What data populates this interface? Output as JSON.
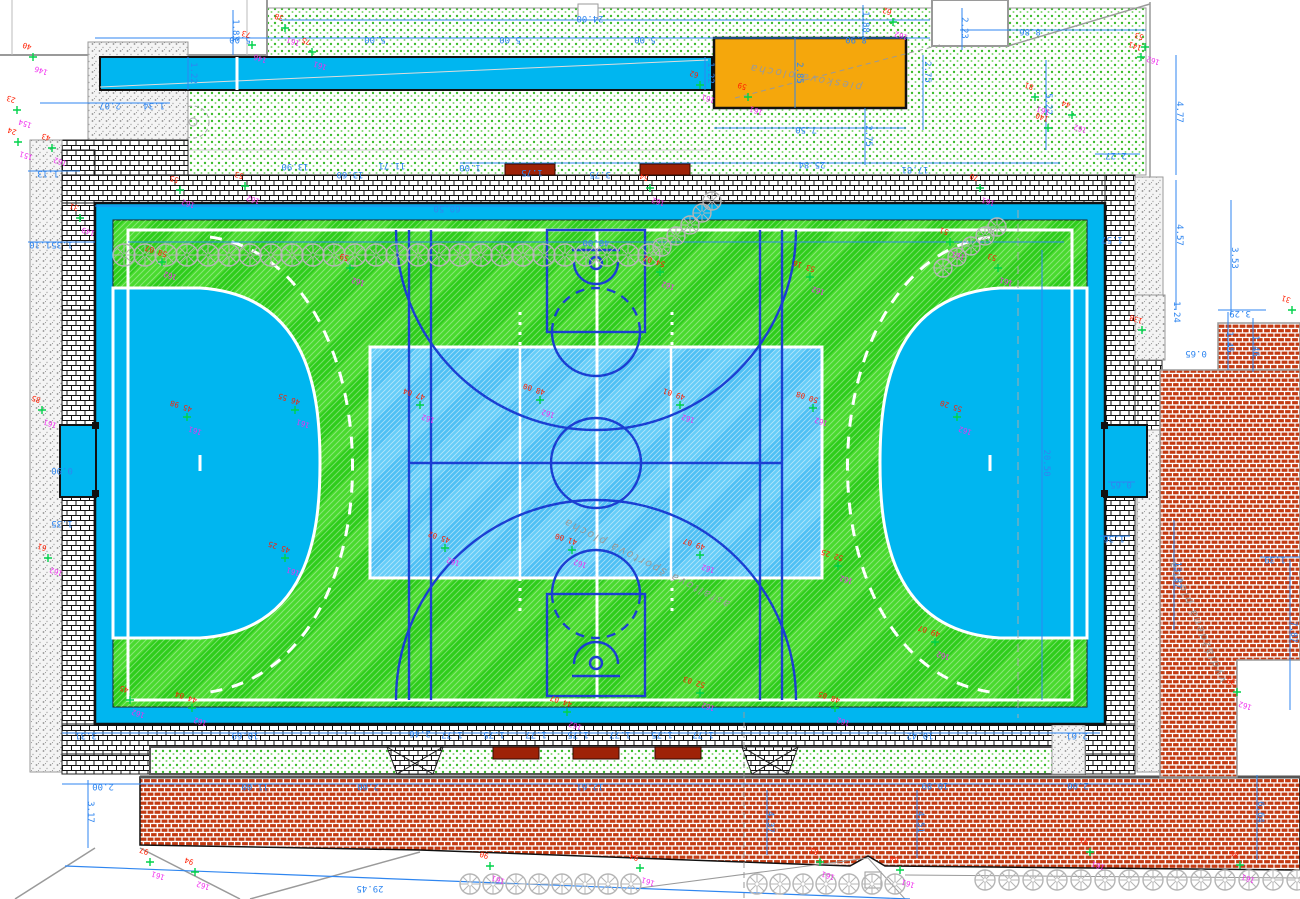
{
  "drawing": {
    "type": "site-plan-sports-field",
    "language": "sk"
  },
  "colors": {
    "dimension_blue": "#2f86f0",
    "spot_magenta": "#f030ee",
    "spot_red": "#ff1e00",
    "cross_green": "#00d24a",
    "court_band_cyan": "#00b6f0",
    "field_green": "#2ecd1b",
    "field_green_light": "#49da2e",
    "basket_court_blue": "#4fc0f4",
    "marking_dark_blue": "#1b3fd2",
    "sand_orange": "#f5a70c",
    "bench_red": "#9e2207",
    "paving_red_brick": "#c33a12",
    "tree_gray": "#b5b5b5"
  },
  "area_labels": [
    {
      "text": "piesková plocha",
      "x": 806,
      "y": 74,
      "rot": 190
    },
    {
      "text": "asfaltová športová plocha",
      "x": 648,
      "y": 560,
      "rot": 207
    },
    {
      "text": "vydláždená plocha",
      "x": 1200,
      "y": 620,
      "rot": 247
    }
  ],
  "dimensions": [
    {
      "t": "24.00",
      "x": 590,
      "y": 16,
      "o": "h"
    },
    {
      "t": "5.00",
      "x": 240,
      "y": 37,
      "o": "h"
    },
    {
      "t": "5.00",
      "x": 375,
      "y": 37,
      "o": "h"
    },
    {
      "t": "5.00",
      "x": 510,
      "y": 37,
      "o": "h"
    },
    {
      "t": "5.00",
      "x": 645,
      "y": 37,
      "o": "h"
    },
    {
      "t": "8.90",
      "x": 856,
      "y": 37,
      "o": "h"
    },
    {
      "t": "1.83",
      "x": 233,
      "y": 30,
      "o": "v"
    },
    {
      "t": "1.88",
      "x": 863,
      "y": 22,
      "o": "v"
    },
    {
      "t": "1.22",
      "x": 191,
      "y": 73,
      "o": "v"
    },
    {
      "t": "1.22",
      "x": 708,
      "y": 73,
      "o": "v"
    },
    {
      "t": "2.85",
      "x": 797,
      "y": 73,
      "o": "v"
    },
    {
      "t": "2.75",
      "x": 925,
      "y": 72,
      "o": "v"
    },
    {
      "t": "2.75",
      "x": 866,
      "y": 136,
      "o": "v"
    },
    {
      "t": "7.50",
      "x": 806,
      "y": 127,
      "o": "h"
    },
    {
      "t": "25.84",
      "x": 812,
      "y": 162,
      "o": "h"
    },
    {
      "t": "17.81",
      "x": 915,
      "y": 167,
      "o": "h"
    },
    {
      "t": "8.86",
      "x": 1030,
      "y": 29,
      "o": "h"
    },
    {
      "t": "5.22",
      "x": 1046,
      "y": 104,
      "o": "v"
    },
    {
      "t": "2.23",
      "x": 962,
      "y": 28,
      "o": "v"
    },
    {
      "t": "2.27",
      "x": 1116,
      "y": 153,
      "o": "h"
    },
    {
      "t": "4.77",
      "x": 1177,
      "y": 112,
      "o": "v"
    },
    {
      "t": "4.57",
      "x": 1177,
      "y": 235,
      "o": "v"
    },
    {
      "t": "3.53",
      "x": 1232,
      "y": 258,
      "o": "v"
    },
    {
      "t": "1.57",
      "x": 1112,
      "y": 237,
      "o": "h"
    },
    {
      "t": "1.24",
      "x": 1174,
      "y": 312,
      "o": "v"
    },
    {
      "t": "0.65",
      "x": 1196,
      "y": 351,
      "o": "h"
    },
    {
      "t": "3.29",
      "x": 1240,
      "y": 311,
      "o": "h"
    },
    {
      "t": "1.45",
      "x": 1227,
      "y": 342,
      "o": "v"
    },
    {
      "t": "1.46",
      "x": 1253,
      "y": 346,
      "o": "v"
    },
    {
      "t": "1.39",
      "x": 1275,
      "y": 557,
      "o": "h"
    },
    {
      "t": "7.87",
      "x": 1291,
      "y": 632,
      "o": "v"
    },
    {
      "t": "13.87",
      "x": 1175,
      "y": 575,
      "o": "v"
    },
    {
      "t": "60.50",
      "x": 447,
      "y": 206,
      "o": "h"
    },
    {
      "t": "40.00",
      "x": 596,
      "y": 240,
      "o": "h"
    },
    {
      "t": "20.50",
      "x": 1044,
      "y": 463,
      "o": "v"
    },
    {
      "t": "0.65",
      "x": 1121,
      "y": 482,
      "o": "h"
    },
    {
      "t": "1.36",
      "x": 1114,
      "y": 536,
      "o": "h"
    },
    {
      "t": "1.10",
      "x": 40,
      "y": 242,
      "o": "h"
    },
    {
      "t": "1.35",
      "x": 62,
      "y": 242,
      "o": "h"
    },
    {
      "t": "2.07",
      "x": 110,
      "y": 103,
      "o": "h"
    },
    {
      "t": "1.34",
      "x": 154,
      "y": 103,
      "o": "h"
    },
    {
      "t": "1.13",
      "x": 48,
      "y": 171,
      "o": "h"
    },
    {
      "t": "13.90",
      "x": 295,
      "y": 164,
      "o": "h"
    },
    {
      "t": "11.71",
      "x": 392,
      "y": 163,
      "o": "h"
    },
    {
      "t": "13.60",
      "x": 350,
      "y": 172,
      "o": "h"
    },
    {
      "t": "1.00",
      "x": 470,
      "y": 165,
      "o": "h"
    },
    {
      "t": "1.75",
      "x": 532,
      "y": 170,
      "o": "h"
    },
    {
      "t": "3.75",
      "x": 600,
      "y": 172,
      "o": "h"
    },
    {
      "t": "0.90",
      "x": 62,
      "y": 468,
      "o": "h"
    },
    {
      "t": "1.35",
      "x": 62,
      "y": 521,
      "o": "h"
    },
    {
      "t": "3.31",
      "x": 86,
      "y": 733,
      "o": "h"
    },
    {
      "t": "10.69",
      "x": 245,
      "y": 733,
      "o": "h"
    },
    {
      "t": "10.42",
      "x": 920,
      "y": 733,
      "o": "h"
    },
    {
      "t": "2.61",
      "x": 1077,
      "y": 733,
      "o": "h"
    },
    {
      "t": "2.46",
      "x": 420,
      "y": 731,
      "o": "h"
    },
    {
      "t": "1.77",
      "x": 452,
      "y": 732,
      "o": "h"
    },
    {
      "t": "1.75",
      "x": 494,
      "y": 732,
      "o": "h"
    },
    {
      "t": "1.77",
      "x": 536,
      "y": 732,
      "o": "h"
    },
    {
      "t": "1.75",
      "x": 578,
      "y": 732,
      "o": "h"
    },
    {
      "t": "1.77",
      "x": 620,
      "y": 732,
      "o": "h"
    },
    {
      "t": "1.75",
      "x": 662,
      "y": 732,
      "o": "h"
    },
    {
      "t": "1.77",
      "x": 703,
      "y": 732,
      "o": "h"
    },
    {
      "t": "2.00",
      "x": 103,
      "y": 784,
      "o": "h"
    },
    {
      "t": "11.00",
      "x": 255,
      "y": 784,
      "o": "h"
    },
    {
      "t": "2.00",
      "x": 368,
      "y": 784,
      "o": "h"
    },
    {
      "t": "12.61",
      "x": 590,
      "y": 784,
      "o": "h"
    },
    {
      "t": "10.89",
      "x": 935,
      "y": 783,
      "o": "h"
    },
    {
      "t": "2.00",
      "x": 1078,
      "y": 783,
      "o": "h"
    },
    {
      "t": "3.17",
      "x": 88,
      "y": 812,
      "o": "v"
    },
    {
      "t": "4.37",
      "x": 768,
      "y": 822,
      "o": "v"
    },
    {
      "t": "4.51",
      "x": 918,
      "y": 822,
      "o": "v"
    },
    {
      "t": "6.64",
      "x": 1258,
      "y": 812,
      "o": "v"
    },
    {
      "t": "29.45",
      "x": 370,
      "y": 886,
      "o": "h"
    }
  ],
  "spot_elevations": [
    {
      "x": 33,
      "y": 57,
      "m": "146",
      "d": "40"
    },
    {
      "x": 17,
      "y": 110,
      "m": "154",
      "d": "23"
    },
    {
      "x": 18,
      "y": 142,
      "m": "151",
      "d": "24"
    },
    {
      "x": 52,
      "y": 148,
      "m": "162",
      "d": "43"
    },
    {
      "x": 80,
      "y": 218,
      "m": "149",
      "d": "31"
    },
    {
      "x": 252,
      "y": 45,
      "m": "146",
      "d": "73"
    },
    {
      "x": 285,
      "y": 28,
      "m": "161",
      "d": "38"
    },
    {
      "x": 312,
      "y": 52,
      "m": "161",
      "d": "75"
    },
    {
      "x": 700,
      "y": 85,
      "m": "161",
      "d": "62"
    },
    {
      "x": 748,
      "y": 97,
      "m": "161",
      "d": "59"
    },
    {
      "x": 893,
      "y": 22,
      "m": "162",
      "d": "62"
    },
    {
      "x": 1145,
      "y": 47,
      "m": "162",
      "d": "53"
    },
    {
      "x": 1072,
      "y": 115,
      "m": "162",
      "d": "44"
    },
    {
      "x": 1048,
      "y": 128,
      "m": "",
      "d": "140"
    },
    {
      "x": 1141,
      "y": 57,
      "m": "",
      "d": "141"
    },
    {
      "x": 180,
      "y": 190,
      "m": "162",
      "d": "55"
    },
    {
      "x": 245,
      "y": 186,
      "m": "162",
      "d": "53"
    },
    {
      "x": 650,
      "y": 188,
      "m": "162",
      "d": "54"
    },
    {
      "x": 980,
      "y": 188,
      "m": "161",
      "d": "70"
    },
    {
      "x": 1035,
      "y": 97,
      "m": "161",
      "d": "81"
    },
    {
      "x": 162,
      "y": 262,
      "m": "162",
      "d": "58 07"
    },
    {
      "x": 350,
      "y": 268,
      "m": "162",
      "d": "59"
    },
    {
      "x": 660,
      "y": 272,
      "m": "162",
      "d": "54 02"
    },
    {
      "x": 810,
      "y": 277,
      "m": "162",
      "d": "53 16"
    },
    {
      "x": 950,
      "y": 242,
      "m": "161",
      "d": "51"
    },
    {
      "x": 998,
      "y": 268,
      "m": "161",
      "d": "53"
    },
    {
      "x": 187,
      "y": 417,
      "m": "161",
      "d": "45 98"
    },
    {
      "x": 295,
      "y": 410,
      "m": "161",
      "d": "46 55"
    },
    {
      "x": 420,
      "y": 405,
      "m": "162",
      "d": "47 04"
    },
    {
      "x": 540,
      "y": 400,
      "m": "162",
      "d": "48 00"
    },
    {
      "x": 680,
      "y": 405,
      "m": "162",
      "d": "49 01"
    },
    {
      "x": 813,
      "y": 408,
      "m": "162",
      "d": "50 08"
    },
    {
      "x": 957,
      "y": 417,
      "m": "162",
      "d": "55 20"
    },
    {
      "x": 445,
      "y": 548,
      "m": "162",
      "d": "45 02"
    },
    {
      "x": 572,
      "y": 550,
      "m": "162",
      "d": "41 00"
    },
    {
      "x": 700,
      "y": 555,
      "m": "162",
      "d": "49 07"
    },
    {
      "x": 838,
      "y": 566,
      "m": "162",
      "d": "52 25"
    },
    {
      "x": 935,
      "y": 642,
      "m": "162",
      "d": "49 07"
    },
    {
      "x": 285,
      "y": 558,
      "m": "161",
      "d": "45 25"
    },
    {
      "x": 700,
      "y": 693,
      "m": "162",
      "d": "52 03"
    },
    {
      "x": 835,
      "y": 708,
      "m": "162",
      "d": "48 05"
    },
    {
      "x": 567,
      "y": 712,
      "m": "162",
      "d": "44 07"
    },
    {
      "x": 130,
      "y": 700,
      "m": "162",
      "d": "45"
    },
    {
      "x": 192,
      "y": 708,
      "m": "162",
      "d": "44 04"
    },
    {
      "x": 48,
      "y": 558,
      "m": "162",
      "d": "61"
    },
    {
      "x": 42,
      "y": 410,
      "m": "161",
      "d": "85"
    },
    {
      "x": 150,
      "y": 862,
      "m": "161",
      "d": "97"
    },
    {
      "x": 195,
      "y": 872,
      "m": "162",
      "d": "94"
    },
    {
      "x": 490,
      "y": 866,
      "m": "161",
      "d": "90"
    },
    {
      "x": 640,
      "y": 868,
      "m": "161",
      "d": "94"
    },
    {
      "x": 820,
      "y": 862,
      "m": "161",
      "d": "81"
    },
    {
      "x": 900,
      "y": 870,
      "m": "161",
      "d": "84"
    },
    {
      "x": 1090,
      "y": 852,
      "m": "161",
      "d": "91"
    },
    {
      "x": 1240,
      "y": 865,
      "m": "161",
      "d": "86"
    },
    {
      "x": 1292,
      "y": 310,
      "m": "",
      "d": "31"
    },
    {
      "x": 1142,
      "y": 330,
      "m": "",
      "d": "138"
    },
    {
      "x": 1237,
      "y": 692,
      "m": "162",
      "d": "33"
    }
  ],
  "trees": {
    "rows": [
      {
        "y": 255,
        "x0": 124,
        "dx": 21,
        "n": 26,
        "r": 11
      },
      {
        "y": 884,
        "x0": 470,
        "dx": 23,
        "n": 8,
        "r": 10
      },
      {
        "y": 884,
        "x0": 757,
        "dx": 23,
        "n": 7,
        "r": 10
      },
      {
        "y": 880,
        "x0": 985,
        "dx": 24,
        "n": 14,
        "r": 10
      }
    ],
    "points": [
      {
        "x": 662,
        "y": 247,
        "r": 9
      },
      {
        "x": 676,
        "y": 236,
        "r": 9
      },
      {
        "x": 690,
        "y": 225,
        "r": 9
      },
      {
        "x": 702,
        "y": 213,
        "r": 9
      },
      {
        "x": 712,
        "y": 201,
        "r": 9
      },
      {
        "x": 943,
        "y": 268,
        "r": 9
      },
      {
        "x": 957,
        "y": 257,
        "r": 9
      },
      {
        "x": 971,
        "y": 246,
        "r": 9
      },
      {
        "x": 985,
        "y": 236,
        "r": 9
      },
      {
        "x": 997,
        "y": 227,
        "r": 9
      }
    ]
  },
  "benches": [
    {
      "x": 505,
      "y": 164,
      "w": 50,
      "h": 11
    },
    {
      "x": 640,
      "y": 164,
      "w": 50,
      "h": 11
    },
    {
      "x": 493,
      "y": 747,
      "w": 46,
      "h": 12
    },
    {
      "x": 573,
      "y": 747,
      "w": 46,
      "h": 12
    },
    {
      "x": 655,
      "y": 747,
      "w": 46,
      "h": 12
    }
  ]
}
